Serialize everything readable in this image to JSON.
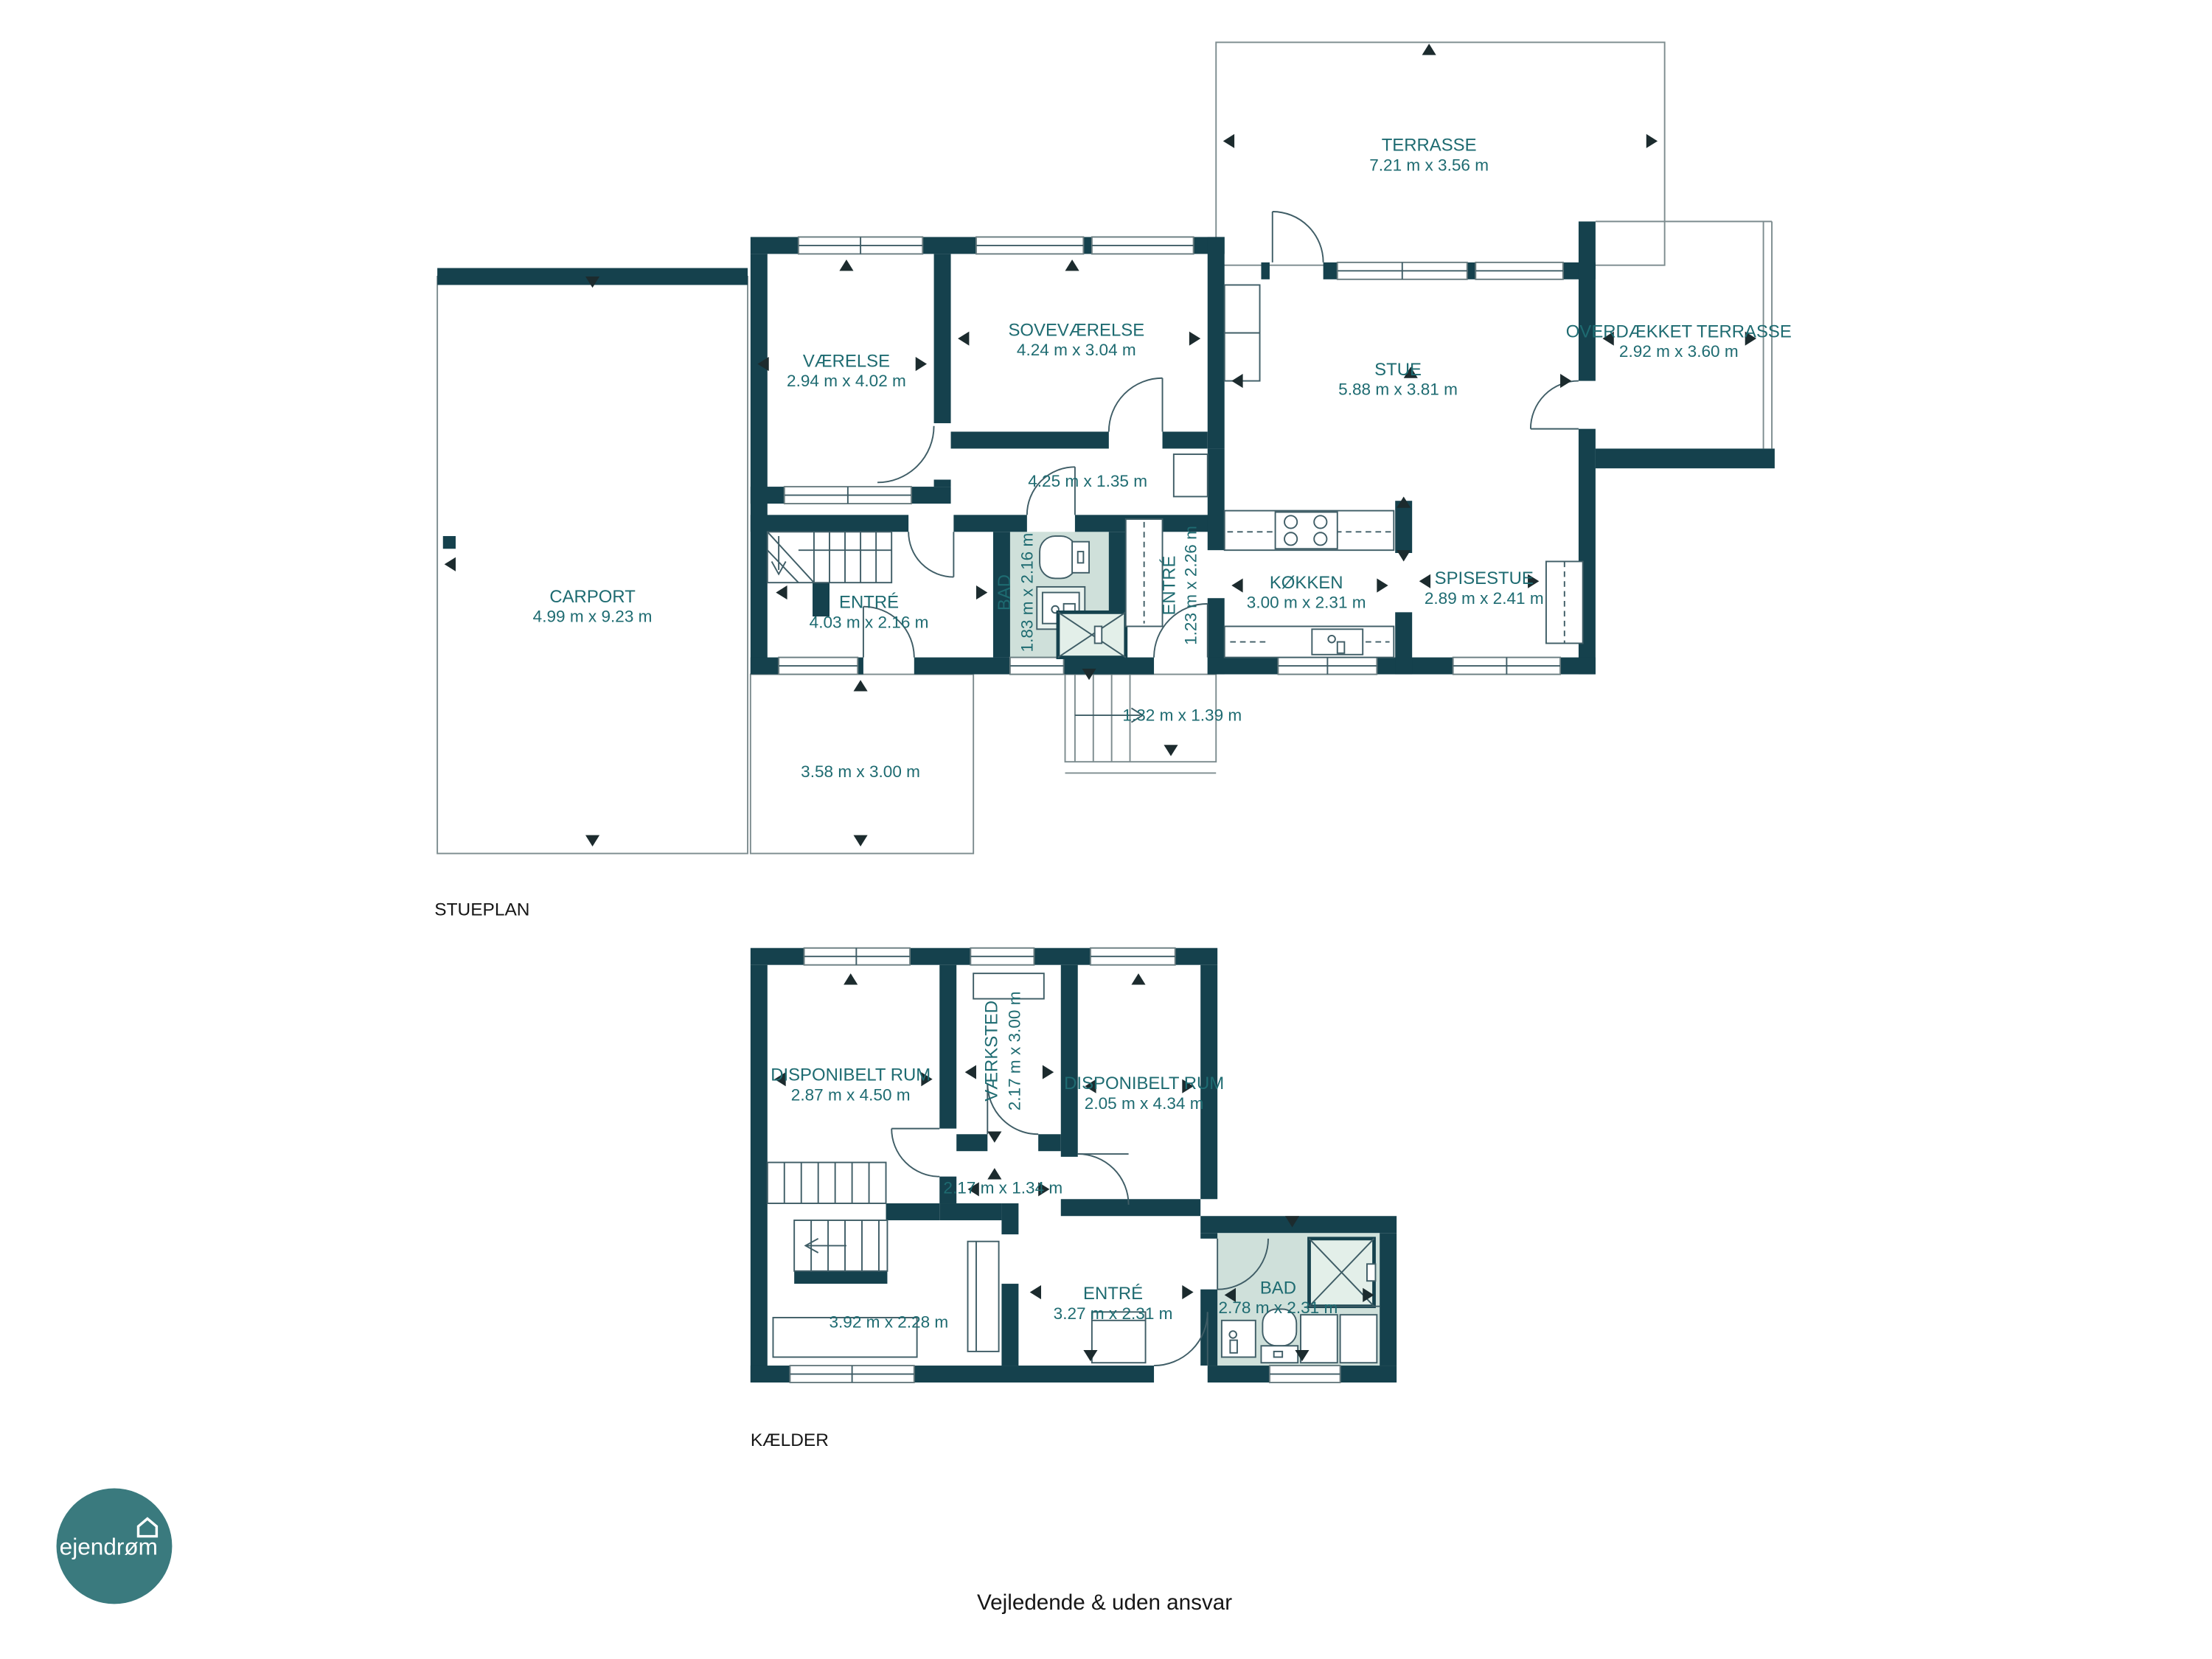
{
  "colors": {
    "wall": "#15414d",
    "room_text": "#1e6b71",
    "bath_fill": "#cfe0da",
    "logo_circle": "#3a7a7e",
    "plain_text": "#161616"
  },
  "logo": {
    "text": "ejendrøm"
  },
  "footer": {
    "disclaimer": "Vejledende & uden ansvar"
  },
  "stueplan": {
    "title": "STUEPLAN",
    "rooms": {
      "terrasse": {
        "name": "TERRASSE",
        "dims": "7.21 m x 3.56 m"
      },
      "vaerelse": {
        "name": "VÆRELSE",
        "dims": "2.94 m x 4.02 m"
      },
      "sovevaerelse": {
        "name": "SOVEVÆRELSE",
        "dims": "4.24 m x 3.04 m"
      },
      "stue": {
        "name": "STUE",
        "dims": "5.88 m x 3.81 m"
      },
      "overdaekket_terrasse": {
        "name": "OVERDÆKKET TERRASSE",
        "dims": "2.92 m x 3.60 m"
      },
      "carport": {
        "name": "CARPORT",
        "dims": "4.99 m x 9.23 m"
      },
      "fordelingsgang": {
        "dims": "4.25 m x 1.35 m"
      },
      "entre": {
        "name": "ENTRÉ",
        "dims": "4.03 m x 2.16 m"
      },
      "bad": {
        "name": "BAD",
        "dims": "1.83 m x 2.16 m"
      },
      "entre2": {
        "name": "ENTRÉ",
        "dims": "1.23 m x 2.26 m"
      },
      "koekken": {
        "name": "KØKKEN",
        "dims": "3.00 m x 2.31 m"
      },
      "spisestue": {
        "name": "SPISESTUE",
        "dims": "2.89 m x 2.41 m"
      },
      "udvendig_trappe": {
        "dims": "1.32 m x 1.39 m"
      },
      "terrasse_syd": {
        "dims": "3.58 m x 3.00 m"
      }
    }
  },
  "kaelder": {
    "title": "KÆLDER",
    "rooms": {
      "disponibelt_rum_1": {
        "name": "DISPONIBELT RUM",
        "dims": "2.87 m x 4.50 m"
      },
      "vaerksted": {
        "name": "VÆRKSTED",
        "dims": "2.17 m x 3.00 m"
      },
      "disponibelt_rum_2": {
        "name": "DISPONIBELT RUM",
        "dims": "2.05 m x 4.34 m"
      },
      "gang": {
        "dims": "2.17 m x 1.34 m"
      },
      "rum_nv": {
        "dims": "3.92 m x 2.28 m"
      },
      "entre": {
        "name": "ENTRÉ",
        "dims": "3.27 m x 2.31 m"
      },
      "bad": {
        "name": "BAD",
        "dims": "2.78 m x 2.31 m"
      }
    }
  }
}
